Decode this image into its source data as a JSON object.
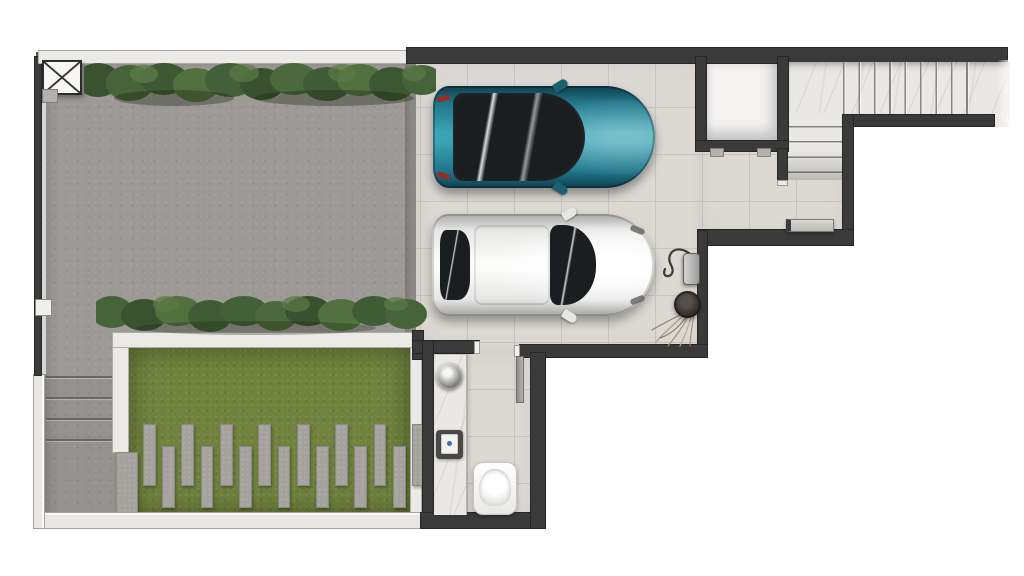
{
  "scene": {
    "title": "Ground-floor plan — top-down architectural render",
    "description": "Top-down 3D render of a house ground floor: paved side yard with two clipped hedges, lawn garden with staggered stepping stones, outdoor steps, a two-car garage (teal car and white car parked facing right), entry foyer with L-shaped marble staircase and shoe bench, storage closet, wall charger with dry plant, and a small bathroom/laundry with marble counter, vessel sink, wall unit and toilet.",
    "background_color": "#ffffff",
    "visible_text": "none"
  },
  "areas": {
    "yard": {
      "label": "paved yard / driveway",
      "surface": "concrete paving",
      "color": "#9c9996"
    },
    "garage": {
      "label": "garage",
      "surface": "ceramic tile",
      "color": "#dcd8d3",
      "cars_parked": 2
    },
    "foyer": {
      "label": "entry foyer",
      "surface": "ceramic tile",
      "color": "#dcd8d3"
    },
    "staircase": {
      "label": "L-shaped marble staircase",
      "material": "white marble",
      "upper_run_treads": 8,
      "lower_run_treads": 5,
      "color": "#eae8e5"
    },
    "closet": {
      "label": "storage closet",
      "color": "#f4f3f1"
    },
    "bathroom": {
      "label": "bathroom / laundry",
      "surface": "ceramic tile",
      "color": "#dcd8d3"
    },
    "garden": {
      "label": "lawn garden with planter border",
      "grass_color": "#71833f",
      "stepping_stones_on_grass": 15,
      "stepping_stones_on_walkway": 1
    },
    "hedges": {
      "label": "clipped hedges",
      "count": 2,
      "color": "#46603a"
    },
    "outdoor_steps": {
      "label": "outdoor steps beside garden",
      "treads": 4
    }
  },
  "objects": {
    "teal_car": {
      "label": "teal car, top view, parked facing right",
      "body_color": "#2e93a6",
      "glass_color": "#1b1e21",
      "taillight_color": "#9c2c22"
    },
    "white_car": {
      "label": "white car, top view, parked facing right",
      "body_color": "#ededec",
      "glass_color": "#26292c"
    },
    "column_symbol": {
      "label": "column symbol (crossed box) at top-left corner"
    },
    "wall_marker": {
      "label": "small white marker on left boundary wall"
    },
    "counter": {
      "label": "marble vanity counter",
      "color": "#efedea"
    },
    "vessel_sink": {
      "label": "round metallic vessel sink"
    },
    "wall_unit": {
      "label": "wall-mounted unit above counter"
    },
    "toilet": {
      "label": "toilet, top view, lid closed"
    },
    "door": {
      "label": "open door leaf between garage and bathroom"
    },
    "ev_charger": {
      "label": "wall-mounted charger with coiled cable"
    },
    "dry_plant": {
      "label": "potted dry plant beside garage wall"
    },
    "bench": {
      "label": "shoe bench at stair landing"
    }
  },
  "palette": {
    "wall-dark": "#3a3a3a",
    "wall-light": "#e9e7e3",
    "paving": "#9c9996",
    "tile": "#dcd8d3",
    "tile-line": "#c9c4bf",
    "marble": "#eae8e5",
    "grass": "#71833f",
    "hedge": "#46603a",
    "paver": "#a5a29e",
    "planter": "#eceae7",
    "car-teal": "#2e93a6",
    "car-white": "#ededec",
    "glass": "#1b1e21",
    "taillight": "#9c2c22"
  }
}
